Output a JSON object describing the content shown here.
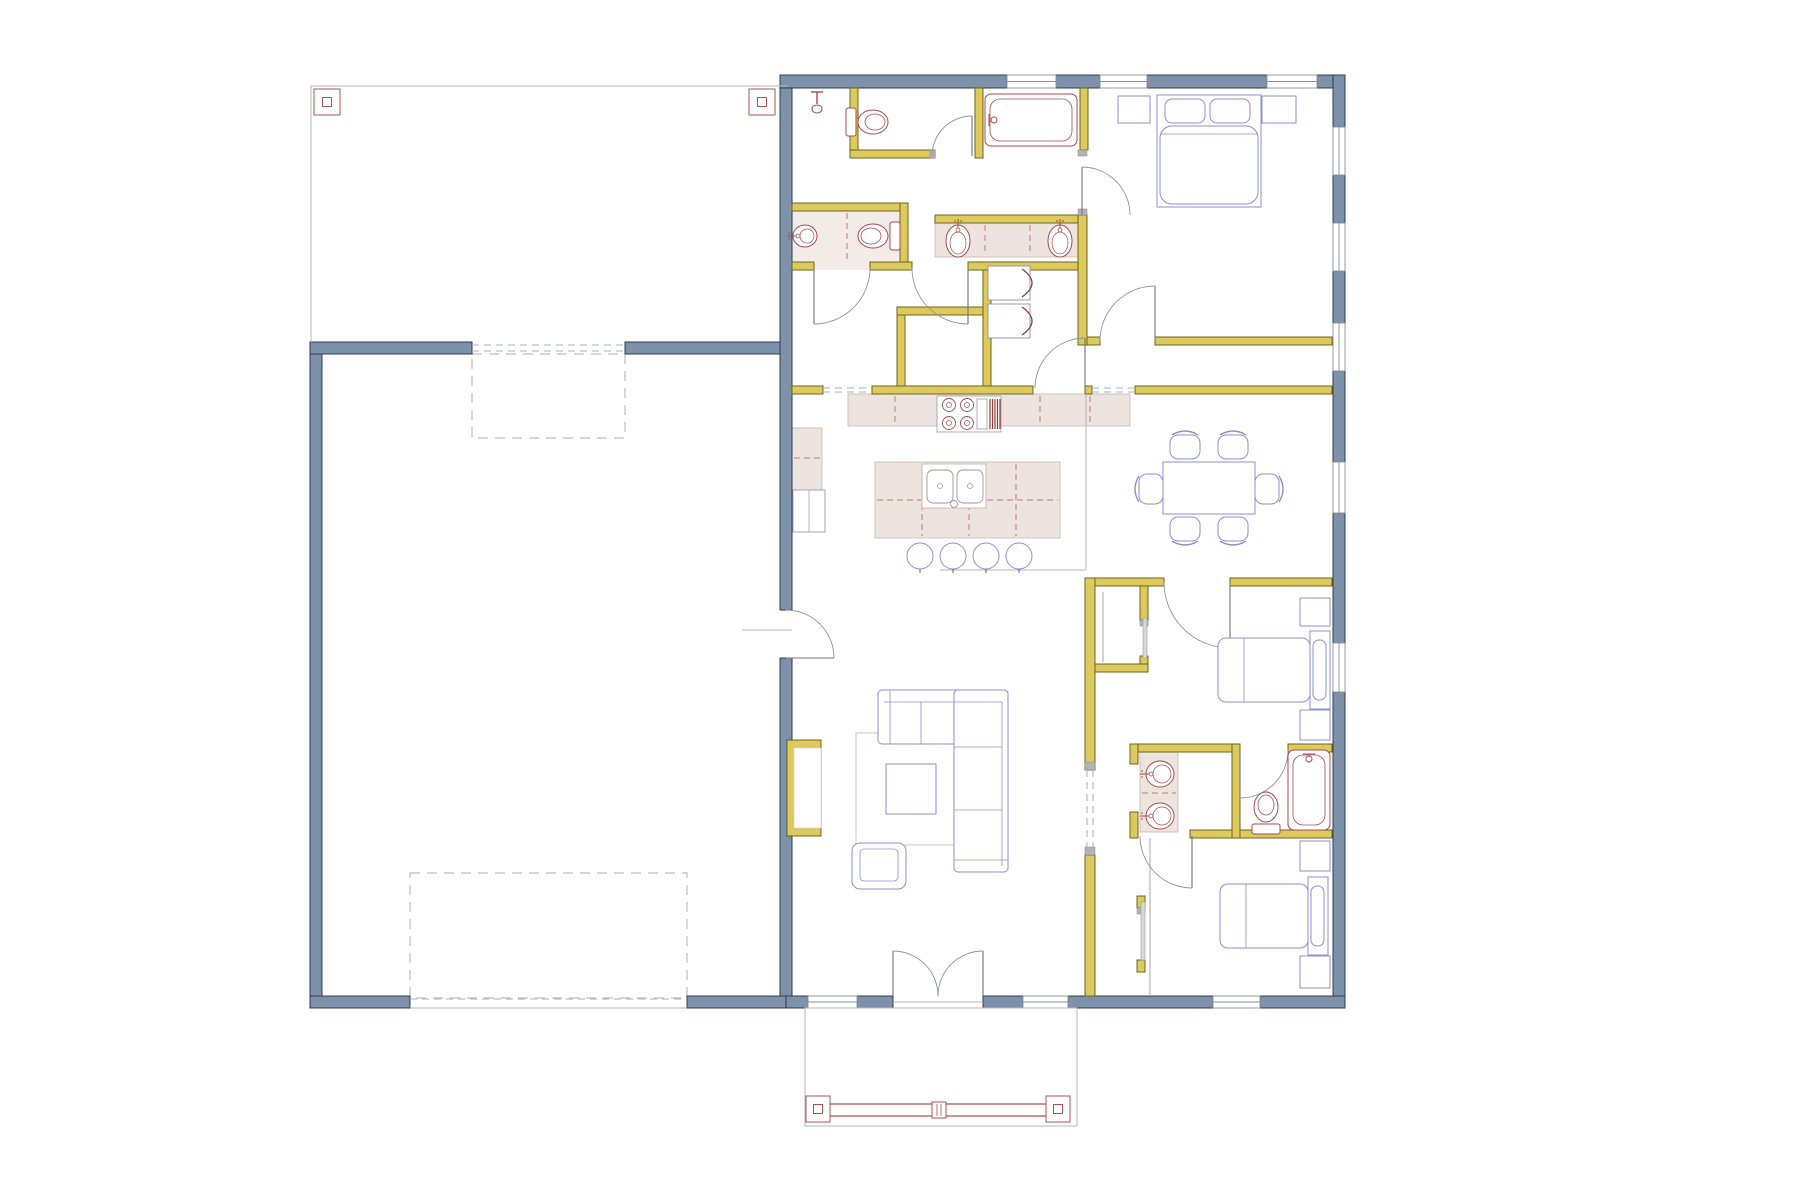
{
  "meta": {
    "title": "Residential floor plan drawing",
    "type": "floor-plan"
  },
  "palette": {
    "ext": "#7e91aa",
    "extStroke": "#2f3c50",
    "int": "#ddca5f",
    "intStroke": "#6f6418",
    "win": "#ffffff",
    "winStroke": "#8a8f96",
    "thin": "#b5b5b5",
    "dash": "#a9b2bd",
    "dashRect": "#bdbdbd",
    "door": "#8f9499",
    "counter": "#ede4e0",
    "counterStroke": "#c8b6ae",
    "counterDash": "#c17f74",
    "tile": "#f2ebe8",
    "plumb": "#a34c4c",
    "furn": "#8a92cc",
    "rug": "#c6c6c6",
    "red": "#b05050",
    "gray": "#9aa0a6",
    "appl": "#8d93a5",
    "cap": "#b3b3b3",
    "panel": "#d8d8d8"
  },
  "carport": {
    "outline": [
      311,
      86,
      477,
      256
    ],
    "posts": [
      [
        314,
        89,
        26,
        26
      ],
      [
        749,
        89,
        26,
        26
      ]
    ]
  },
  "porch": {
    "outline": [
      805,
      1008,
      272,
      118
    ],
    "rails": [
      [
        830,
        1104,
        1046,
        1104
      ],
      [
        830,
        1116,
        1046,
        1116
      ]
    ],
    "posts": [
      [
        806,
        1096,
        24,
        26
      ],
      [
        1046,
        1096,
        24,
        26
      ]
    ],
    "center_post": [
      932,
      1102,
      14,
      16
    ]
  },
  "dashed_rects": [
    [
      472,
      354,
      153,
      84
    ],
    [
      410,
      873,
      277,
      125
    ]
  ],
  "exterior_walls": [
    [
      310,
      342,
      12,
      666
    ],
    [
      310,
      996,
      100,
      12
    ],
    [
      687,
      996,
      105,
      12
    ],
    [
      310,
      342,
      162,
      12
    ],
    [
      625,
      342,
      167,
      12
    ],
    [
      780,
      88,
      12,
      522
    ],
    [
      780,
      658,
      12,
      338
    ],
    [
      780,
      75,
      227,
      13
    ],
    [
      1056,
      75,
      44,
      13
    ],
    [
      1147,
      75,
      120,
      13
    ],
    [
      1317,
      75,
      28,
      13
    ],
    [
      1333,
      75,
      12,
      52
    ],
    [
      1333,
      175,
      12,
      48
    ],
    [
      1333,
      271,
      12,
      52
    ],
    [
      1333,
      371,
      12,
      91
    ],
    [
      1333,
      513,
      12,
      130
    ],
    [
      1333,
      692,
      12,
      316
    ],
    [
      786,
      996,
      22,
      12
    ],
    [
      857,
      996,
      36,
      12
    ],
    [
      983,
      996,
      40,
      12
    ],
    [
      1068,
      996,
      145,
      12
    ],
    [
      1260,
      996,
      85,
      12
    ]
  ],
  "windows": [
    [
      1007,
      75,
      49,
      13
    ],
    [
      1100,
      75,
      47,
      13
    ],
    [
      1267,
      75,
      50,
      13
    ],
    [
      1333,
      127,
      12,
      48
    ],
    [
      1333,
      223,
      12,
      48
    ],
    [
      1333,
      323,
      12,
      48
    ],
    [
      1333,
      462,
      12,
      51
    ],
    [
      1333,
      643,
      12,
      49
    ],
    [
      808,
      996,
      49,
      12
    ],
    [
      1023,
      996,
      45,
      12
    ],
    [
      1213,
      996,
      47,
      12
    ]
  ],
  "interior_walls": [
    [
      850,
      88,
      8,
      70
    ],
    [
      850,
      150,
      85,
      8
    ],
    [
      975,
      88,
      8,
      70
    ],
    [
      1080,
      88,
      8,
      62
    ],
    [
      792,
      203,
      108,
      8
    ],
    [
      900,
      203,
      8,
      67
    ],
    [
      935,
      215,
      150,
      8
    ],
    [
      792,
      262,
      22,
      8
    ],
    [
      870,
      262,
      42,
      8
    ],
    [
      968,
      262,
      117,
      8
    ],
    [
      897,
      307,
      86,
      8
    ],
    [
      897,
      315,
      8,
      71
    ],
    [
      983,
      270,
      8,
      116
    ],
    [
      1078,
      215,
      9,
      130
    ],
    [
      1087,
      337,
      13,
      8
    ],
    [
      1155,
      337,
      177,
      8
    ],
    [
      792,
      386,
      31,
      8
    ],
    [
      872,
      386,
      161,
      8
    ],
    [
      1085,
      386,
      7,
      8
    ],
    [
      1135,
      386,
      197,
      8
    ],
    [
      1085,
      578,
      79,
      8
    ],
    [
      1230,
      578,
      102,
      8
    ],
    [
      1085,
      578,
      10,
      192
    ],
    [
      1085,
      855,
      10,
      141
    ],
    [
      1140,
      586,
      8,
      34
    ],
    [
      1140,
      656,
      8,
      8
    ],
    [
      1095,
      664,
      53,
      8
    ],
    [
      1130,
      744,
      110,
      8
    ],
    [
      1288,
      744,
      44,
      8
    ],
    [
      1130,
      830,
      7,
      8
    ],
    [
      1190,
      830,
      142,
      8
    ],
    [
      1130,
      744,
      8,
      20
    ],
    [
      1130,
      812,
      8,
      26
    ],
    [
      1232,
      744,
      8,
      94
    ],
    [
      1137,
      896,
      8,
      12
    ],
    [
      1137,
      960,
      8,
      12
    ]
  ],
  "fireplace": {
    "outer": [
      787,
      740,
      34,
      96
    ],
    "inner": [
      794,
      748,
      27,
      80
    ]
  },
  "gray_caps": [
    [
      1085,
      762,
      10,
      8
    ],
    [
      1085,
      847,
      10,
      8
    ],
    [
      930,
      150,
      5,
      8
    ],
    [
      1078,
      150,
      9,
      6
    ],
    [
      1078,
      209,
      9,
      6
    ],
    [
      1140,
      620,
      8,
      6
    ],
    [
      1137,
      908,
      8,
      6
    ]
  ],
  "closet_panels": [
    [
      1143,
      618,
      4,
      40
    ],
    [
      1141,
      902,
      4,
      58
    ]
  ],
  "closet_lines": [
    [
      1150,
      838,
      1150,
      996
    ],
    [
      1103,
      592,
      1103,
      662
    ]
  ],
  "thin_lines": [
    [
      311,
      86,
      788,
      86
    ],
    [
      311,
      86,
      311,
      342
    ],
    [
      742,
      630,
      792,
      630
    ],
    [
      1086,
      394,
      1086,
      570
    ],
    [
      940,
      570,
      1085,
      570
    ],
    [
      410,
      1008,
      687,
      1008
    ],
    [
      893,
      1002,
      983,
      1002
    ]
  ],
  "dashed_pairs": [
    [
      472,
      345,
      625,
      345
    ],
    [
      472,
      351,
      625,
      351
    ],
    [
      410,
      999,
      687,
      999
    ],
    [
      823,
      388,
      872,
      388
    ],
    [
      823,
      392,
      872,
      392
    ],
    [
      1092,
      388,
      1135,
      388
    ],
    [
      1092,
      392,
      1135,
      392
    ],
    [
      1087,
      770,
      1087,
      855
    ],
    [
      1093,
      770,
      1093,
      855
    ]
  ],
  "counters": [
    [
      848,
      394,
      282,
      32
    ],
    [
      792,
      428,
      30,
      62
    ],
    [
      875,
      462,
      185,
      76
    ],
    [
      935,
      223,
      148,
      34
    ],
    [
      1140,
      752,
      38,
      80
    ]
  ],
  "tile_floors": [
    [
      792,
      211,
      108,
      59
    ]
  ],
  "counter_dashes": [
    [
      895,
      396,
      895,
      424
    ],
    [
      1040,
      396,
      1040,
      424
    ],
    [
      1090,
      396,
      1090,
      424
    ],
    [
      922,
      464,
      922,
      536
    ],
    [
      969,
      464,
      969,
      536
    ],
    [
      1016,
      464,
      1016,
      536
    ],
    [
      877,
      500,
      1058,
      500
    ],
    [
      985,
      225,
      985,
      255
    ],
    [
      1030,
      225,
      1030,
      255
    ],
    [
      794,
      458,
      821,
      458
    ],
    [
      847,
      213,
      847,
      260
    ],
    [
      1142,
      793,
      1176,
      793
    ]
  ],
  "doors": [
    {
      "h": [
        786,
        658
      ],
      "r": 48,
      "a0": 0,
      "a1": -90
    },
    {
      "h": [
        893,
        996
      ],
      "r": 45,
      "a0": -90,
      "a1": 0
    },
    {
      "h": [
        983,
        996
      ],
      "r": 45,
      "a0": -90,
      "a1": -180
    },
    {
      "h": [
        972,
        156
      ],
      "r": 40,
      "a0": -90,
      "a1": -180
    },
    {
      "h": [
        814,
        268
      ],
      "r": 56,
      "a0": 90,
      "a1": 0
    },
    {
      "h": [
        968,
        268
      ],
      "r": 56,
      "a0": 90,
      "a1": 180
    },
    {
      "h": [
        1085,
        388
      ],
      "r": 50,
      "a0": 270,
      "a1": 180
    },
    {
      "h": [
        1082,
        215
      ],
      "r": 48,
      "a0": -90,
      "a1": 0
    },
    {
      "h": [
        1155,
        341
      ],
      "r": 55,
      "a0": 270,
      "a1": 180
    },
    {
      "h": [
        1230,
        582
      ],
      "r": 66,
      "a0": 90,
      "a1": 180
    },
    {
      "h": [
        1240,
        750
      ],
      "r": 48,
      "a0": 90,
      "a1": 0
    },
    {
      "h": [
        1192,
        836
      ],
      "r": 52,
      "a0": 90,
      "a1": 180
    }
  ],
  "fixtures": {
    "toilets": [
      {
        "c": [
          872,
          122
        ],
        "deg": 0
      },
      {
        "c": [
          874,
          236
        ],
        "deg": 180
      },
      {
        "c": [
          1266,
          808
        ],
        "deg": -90
      }
    ],
    "sinks": [
      {
        "c": [
          958,
          241
        ],
        "deg": 90,
        "rx": 16,
        "ry": 12
      },
      {
        "c": [
          1060,
          241
        ],
        "deg": 90,
        "rx": 16,
        "ry": 12
      },
      {
        "c": [
          805,
          236
        ],
        "deg": 0,
        "rx": 12,
        "ry": 11
      },
      {
        "c": [
          1160,
          774
        ],
        "deg": 0,
        "rx": 14,
        "ry": 13
      },
      {
        "c": [
          1160,
          816
        ],
        "deg": 0,
        "rx": 14,
        "ry": 13
      }
    ],
    "tubs": [
      {
        "r": [
          985,
          94,
          92,
          52
        ],
        "f": "w"
      },
      {
        "r": [
          1288,
          750,
          42,
          80
        ],
        "f": "n"
      }
    ],
    "shower_head": [
      817,
      92
    ],
    "range": [
      937,
      396,
      64,
      36
    ],
    "island_sink": [
      922,
      464,
      64,
      44
    ],
    "washer_dryer": [
      [
        988,
        266,
        42,
        34
      ],
      [
        988,
        304,
        42,
        34
      ]
    ],
    "fridge": [
      793,
      490,
      32,
      42
    ]
  },
  "furniture": {
    "master_bed": {
      "body": [
        1157,
        95,
        104,
        112
      ],
      "pillows": [
        [
          1165,
          99,
          40,
          24
        ],
        [
          1210,
          99,
          40,
          24
        ]
      ],
      "blanket": [
        1160,
        126,
        98,
        78
      ],
      "fold": [
        1160,
        134,
        1258,
        134
      ]
    },
    "beds_h": [
      {
        "body": [
          1218,
          638,
          92,
          64
        ],
        "head": [
          1310,
          631,
          20,
          78
        ],
        "pillow": [
          1313,
          640,
          13,
          60
        ],
        "fold": [
          1244,
          638,
          1244,
          702
        ]
      },
      {
        "body": [
          1220,
          884,
          88,
          64
        ],
        "head": [
          1308,
          877,
          20,
          78
        ],
        "pillow": [
          1311,
          886,
          13,
          60
        ],
        "fold": [
          1246,
          884,
          1246,
          948
        ]
      }
    ],
    "nightstands": [
      [
        1118,
        96,
        32,
        27
      ],
      [
        1262,
        96,
        34,
        27
      ],
      [
        1300,
        598,
        30,
        28
      ],
      [
        1300,
        710,
        30,
        30
      ],
      [
        1300,
        841,
        30,
        30
      ],
      [
        1300,
        956,
        30,
        32
      ]
    ],
    "sofa": {
      "rects": [
        [
          878,
          690,
          130,
          54
        ],
        [
          954,
          690,
          54,
          182
        ]
      ],
      "lines": [
        [
          884,
          702,
          1002,
          702
        ],
        [
          1002,
          702,
          1002,
          866
        ],
        [
          921,
          702,
          921,
          744
        ],
        [
          890,
          690,
          890,
          744
        ],
        [
          954,
          747,
          1002,
          747
        ],
        [
          954,
          810,
          1002,
          810
        ],
        [
          954,
          860,
          1008,
          860
        ]
      ]
    },
    "armchair": {
      "outer": [
        852,
        843,
        54,
        46
      ],
      "inner": [
        860,
        849,
        38,
        32
      ]
    },
    "rug": [
      856,
      733,
      112,
      112
    ],
    "coffee_table": [
      886,
      764,
      50,
      50
    ],
    "dining_table": [
      1163,
      462,
      92,
      52
    ],
    "chairs": [
      {
        "c": [
          1185,
          446
        ],
        "deg": 0
      },
      {
        "c": [
          1233,
          446
        ],
        "deg": 0
      },
      {
        "c": [
          1185,
          530
        ],
        "deg": 180
      },
      {
        "c": [
          1233,
          530
        ],
        "deg": 180
      },
      {
        "c": [
          1150,
          489
        ],
        "deg": -90
      },
      {
        "c": [
          1268,
          489
        ],
        "deg": 90
      }
    ],
    "stools": [
      [
        920,
        556
      ],
      [
        953,
        556
      ],
      [
        986,
        556
      ],
      [
        1019,
        556
      ]
    ]
  }
}
